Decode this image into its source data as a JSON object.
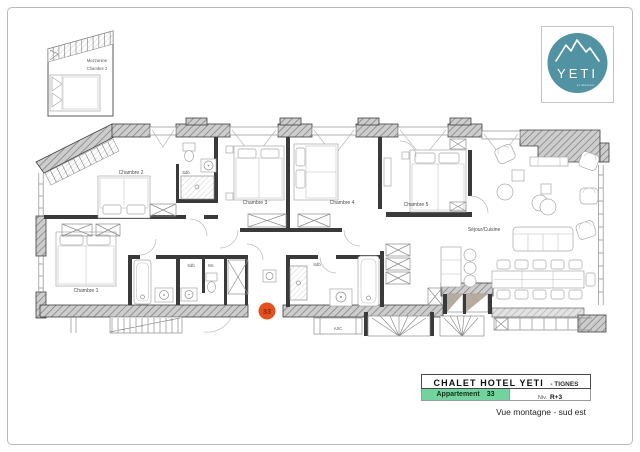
{
  "logo": {
    "name": "YETI",
    "tagline": "et alentour",
    "circle_color": "#5193a3"
  },
  "inset": {
    "label_line1": "Mezzanine",
    "label_line2": "Chambre 2"
  },
  "plan": {
    "marker": {
      "number": "33",
      "fill_color": "#e4511f",
      "text_color": "#8d2b09"
    },
    "rooms": [
      {
        "label": "Chambre 2"
      },
      {
        "label": "Sdb"
      },
      {
        "label": "Chambre 3"
      },
      {
        "label": "Chambre 4"
      },
      {
        "label": "Chambre 5"
      },
      {
        "label": "Séjour/Cuisine"
      },
      {
        "label": "Chambre 1"
      },
      {
        "label": "Sdb"
      },
      {
        "label": "Wc"
      },
      {
        "label": "Sdb"
      },
      {
        "label": "ASC"
      }
    ]
  },
  "title_block": {
    "hotel_name": "CHALET HOTEL YETI",
    "location_suffix": "- TIGNES",
    "apartment_label": "Appartement",
    "apartment_number": "33",
    "level_label": "Niv.",
    "level_value": "R+3",
    "view_caption": "Vue montagne - sud est",
    "highlight_color": "#72d39e"
  }
}
